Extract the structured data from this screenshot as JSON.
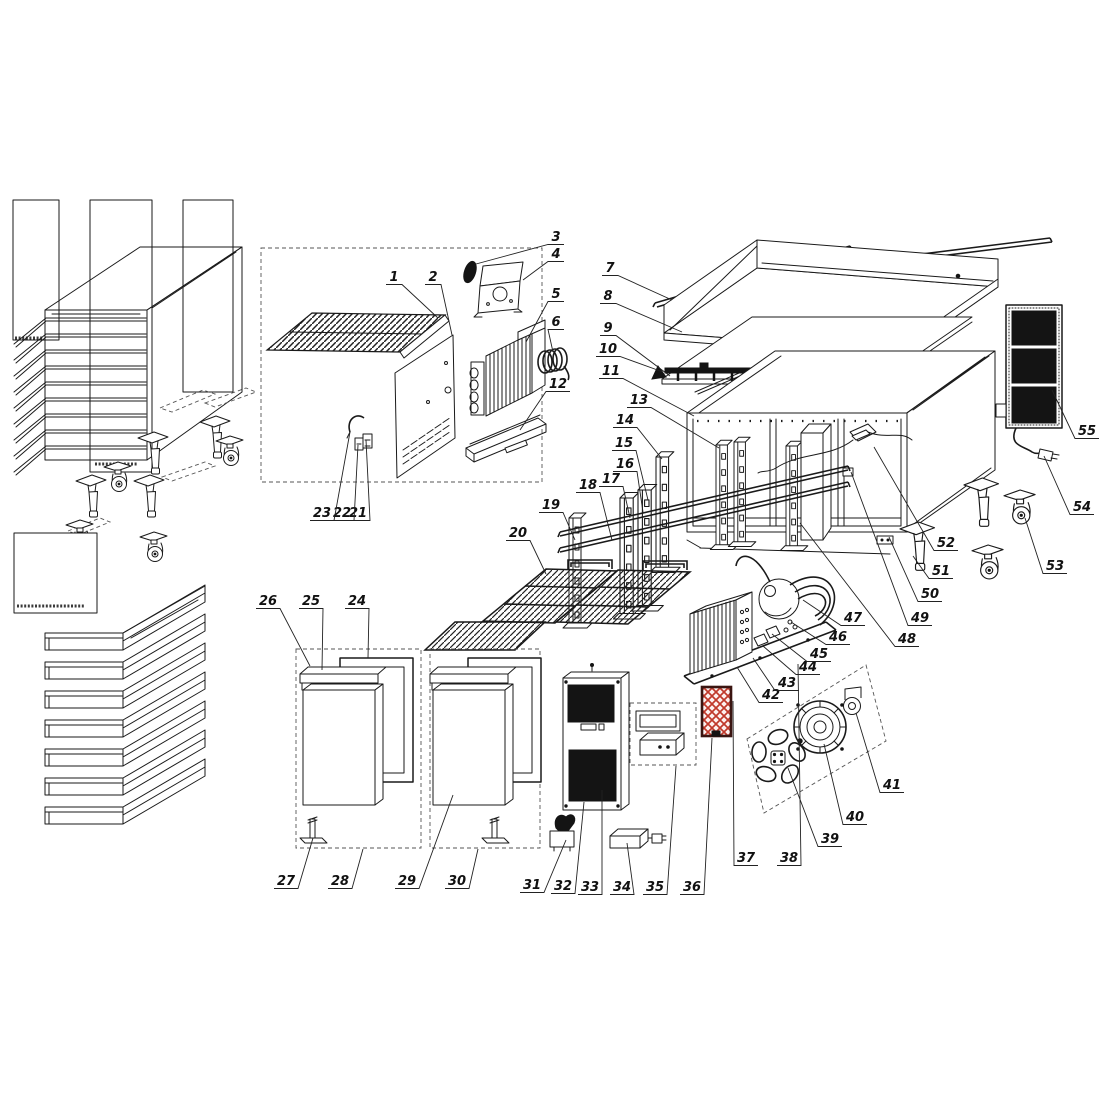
{
  "diagram": {
    "type": "exploded-parts-diagram",
    "subject": "commercial-refrigerated-counter",
    "colors": {
      "line": "#1a1a1a",
      "filter_red": "#c0392b",
      "panel_black": "#141414"
    },
    "labels": [
      {
        "n": "1",
        "x": 394,
        "y": 281,
        "tx": 438,
        "ty": 318
      },
      {
        "n": "2",
        "x": 433,
        "y": 281,
        "tx": 452,
        "ty": 335
      },
      {
        "n": "3",
        "x": 556,
        "y": 241,
        "tx": 476,
        "ty": 264
      },
      {
        "n": "4",
        "x": 556,
        "y": 258,
        "tx": 523,
        "ty": 280
      },
      {
        "n": "5",
        "x": 556,
        "y": 298,
        "tx": 526,
        "ty": 342
      },
      {
        "n": "6",
        "x": 556,
        "y": 326,
        "tx": 553,
        "ty": 352
      },
      {
        "n": "7",
        "x": 610,
        "y": 272,
        "tx": 672,
        "ty": 300
      },
      {
        "n": "8",
        "x": 608,
        "y": 300,
        "tx": 682,
        "ty": 332
      },
      {
        "n": "9",
        "x": 608,
        "y": 332,
        "tx": 670,
        "ty": 376
      },
      {
        "n": "10",
        "x": 608,
        "y": 353,
        "tx": 663,
        "ty": 372
      },
      {
        "n": "11",
        "x": 611,
        "y": 375,
        "tx": 694,
        "ty": 416
      },
      {
        "n": "12",
        "x": 558,
        "y": 388,
        "tx": 520,
        "ty": 430
      },
      {
        "n": "13",
        "x": 639,
        "y": 404,
        "tx": 719,
        "ty": 448
      },
      {
        "n": "14",
        "x": 625,
        "y": 424,
        "tx": 662,
        "ty": 459
      },
      {
        "n": "15",
        "x": 624,
        "y": 447,
        "tx": 648,
        "ty": 500
      },
      {
        "n": "16",
        "x": 625,
        "y": 468,
        "tx": 643,
        "ty": 512
      },
      {
        "n": "17",
        "x": 611,
        "y": 483,
        "tx": 630,
        "ty": 518
      },
      {
        "n": "18",
        "x": 588,
        "y": 489,
        "tx": 612,
        "ty": 540
      },
      {
        "n": "19",
        "x": 551,
        "y": 509,
        "tx": 575,
        "ty": 540
      },
      {
        "n": "20",
        "x": 518,
        "y": 537,
        "tx": 546,
        "ty": 574
      },
      {
        "n": "21",
        "x": 358,
        "y": 517,
        "tx": 366,
        "ty": 440
      },
      {
        "n": "22",
        "x": 342,
        "y": 517,
        "tx": 358,
        "ty": 445
      },
      {
        "n": "23",
        "x": 322,
        "y": 517,
        "tx": 350,
        "ty": 432
      },
      {
        "n": "24",
        "x": 357,
        "y": 605,
        "tx": 368,
        "ty": 658
      },
      {
        "n": "25",
        "x": 311,
        "y": 605,
        "tx": 322,
        "ty": 670
      },
      {
        "n": "26",
        "x": 268,
        "y": 605,
        "tx": 310,
        "ty": 666
      },
      {
        "n": "27",
        "x": 286,
        "y": 885,
        "tx": 313,
        "ty": 838
      },
      {
        "n": "28",
        "x": 340,
        "y": 885,
        "tx": 363,
        "ty": 849
      },
      {
        "n": "29",
        "x": 407,
        "y": 885,
        "tx": 453,
        "ty": 795
      },
      {
        "n": "30",
        "x": 457,
        "y": 885,
        "tx": 478,
        "ty": 849
      },
      {
        "n": "31",
        "x": 532,
        "y": 889,
        "tx": 566,
        "ty": 840
      },
      {
        "n": "32",
        "x": 563,
        "y": 890,
        "tx": 584,
        "ty": 802
      },
      {
        "n": "33",
        "x": 590,
        "y": 891,
        "tx": 602,
        "ty": 790
      },
      {
        "n": "34",
        "x": 622,
        "y": 891,
        "tx": 627,
        "ty": 843
      },
      {
        "n": "35",
        "x": 655,
        "y": 891,
        "tx": 676,
        "ty": 766
      },
      {
        "n": "36",
        "x": 692,
        "y": 891,
        "tx": 712,
        "ty": 738
      },
      {
        "n": "37",
        "x": 746,
        "y": 862,
        "tx": 733,
        "ty": 701
      },
      {
        "n": "38",
        "x": 789,
        "y": 862,
        "tx": 798,
        "ty": 664
      },
      {
        "n": "39",
        "x": 830,
        "y": 843,
        "tx": 788,
        "ty": 768
      },
      {
        "n": "40",
        "x": 855,
        "y": 821,
        "tx": 824,
        "ty": 744
      },
      {
        "n": "41",
        "x": 892,
        "y": 789,
        "tx": 856,
        "ty": 713
      },
      {
        "n": "42",
        "x": 771,
        "y": 699,
        "tx": 737,
        "ty": 667
      },
      {
        "n": "43",
        "x": 787,
        "y": 687,
        "tx": 753,
        "ty": 658
      },
      {
        "n": "44",
        "x": 808,
        "y": 671,
        "tx": 763,
        "ty": 646
      },
      {
        "n": "45",
        "x": 819,
        "y": 658,
        "tx": 772,
        "ty": 634
      },
      {
        "n": "46",
        "x": 838,
        "y": 641,
        "tx": 791,
        "ty": 622
      },
      {
        "n": "47",
        "x": 853,
        "y": 622,
        "tx": 803,
        "ty": 600
      },
      {
        "n": "48",
        "x": 907,
        "y": 643,
        "tx": 800,
        "ty": 523
      },
      {
        "n": "49",
        "x": 920,
        "y": 622,
        "tx": 851,
        "ty": 472
      },
      {
        "n": "50",
        "x": 930,
        "y": 598,
        "tx": 889,
        "ty": 537
      },
      {
        "n": "51",
        "x": 941,
        "y": 575,
        "tx": 913,
        "ty": 556
      },
      {
        "n": "52",
        "x": 946,
        "y": 547,
        "tx": 874,
        "ty": 447
      },
      {
        "n": "53",
        "x": 1055,
        "y": 570,
        "tx": 1025,
        "ty": 518
      },
      {
        "n": "54",
        "x": 1082,
        "y": 511,
        "tx": 1044,
        "ty": 456
      },
      {
        "n": "55",
        "x": 1087,
        "y": 435,
        "tx": 1052,
        "ty": 390
      }
    ]
  }
}
